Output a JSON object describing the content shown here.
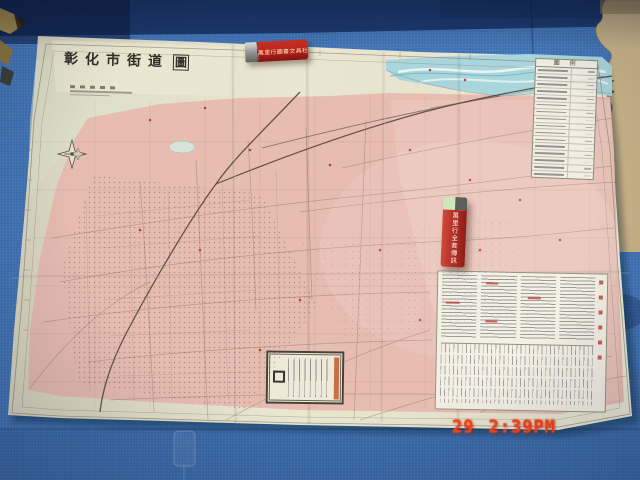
{
  "scene": {
    "description": "photo of a folded paper street map lying on a blue interlocking foam mat floor",
    "camera_timestamp": {
      "day": "29",
      "time": "2:39PM"
    }
  },
  "map": {
    "title_main": "彰化市街道",
    "title_seal": "圖",
    "legend_header": "圖 例",
    "legend_row_count": 16
  },
  "objects": {
    "lighter_horizontal": {
      "brand_text": "萬里行圖書文具社"
    },
    "lighter_vertical": {
      "brand_text": "萬里行全套傳訊"
    }
  },
  "colors": {
    "mat_blue": "#3f72b4",
    "mat_navy": "#1c3a6e",
    "mat_beige": "#c9b488",
    "paper": "#eae7d1",
    "urban_pink": "#e7bcb1",
    "river_blue": "#a9d6dc",
    "lighter_red": "#bf2a1f",
    "timestamp_red": "#f6431c"
  }
}
